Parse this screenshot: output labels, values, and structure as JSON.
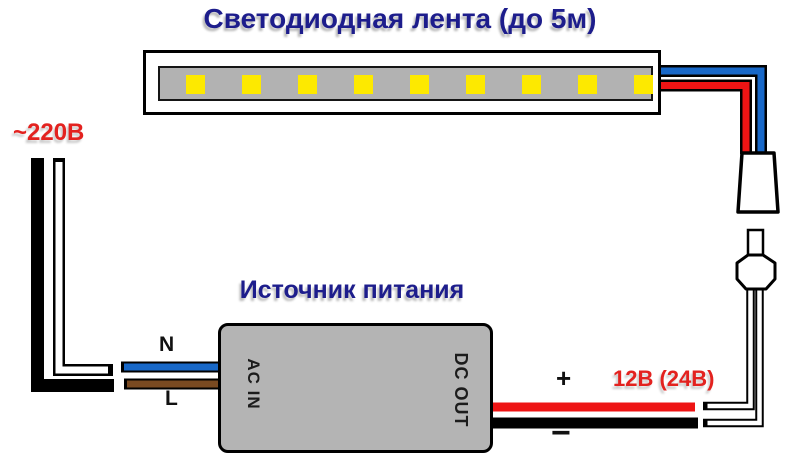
{
  "diagram": {
    "title": "Светодиодная лента (до 5м)",
    "psu_title": "Источник питания",
    "labels": {
      "mains_voltage": "~220В",
      "neutral": "N",
      "line": "L",
      "plus": "+",
      "minus": "−",
      "output_voltage": "12В (24В)",
      "ac_in": "AC IN",
      "dc_out": "DC OUT"
    },
    "led_strip": {
      "led_count": 9
    },
    "colors": {
      "title_navy": "#1d1d8c",
      "label_red": "#e3221f",
      "wire_blue": "#1868c8",
      "wire_brown": "#7a4a21",
      "wire_red": "#ee1414",
      "wire_black": "#000000",
      "led_yellow": "#fde900",
      "strip_gray": "#b2b2b2",
      "psu_gray": "#b4b4b4"
    }
  }
}
